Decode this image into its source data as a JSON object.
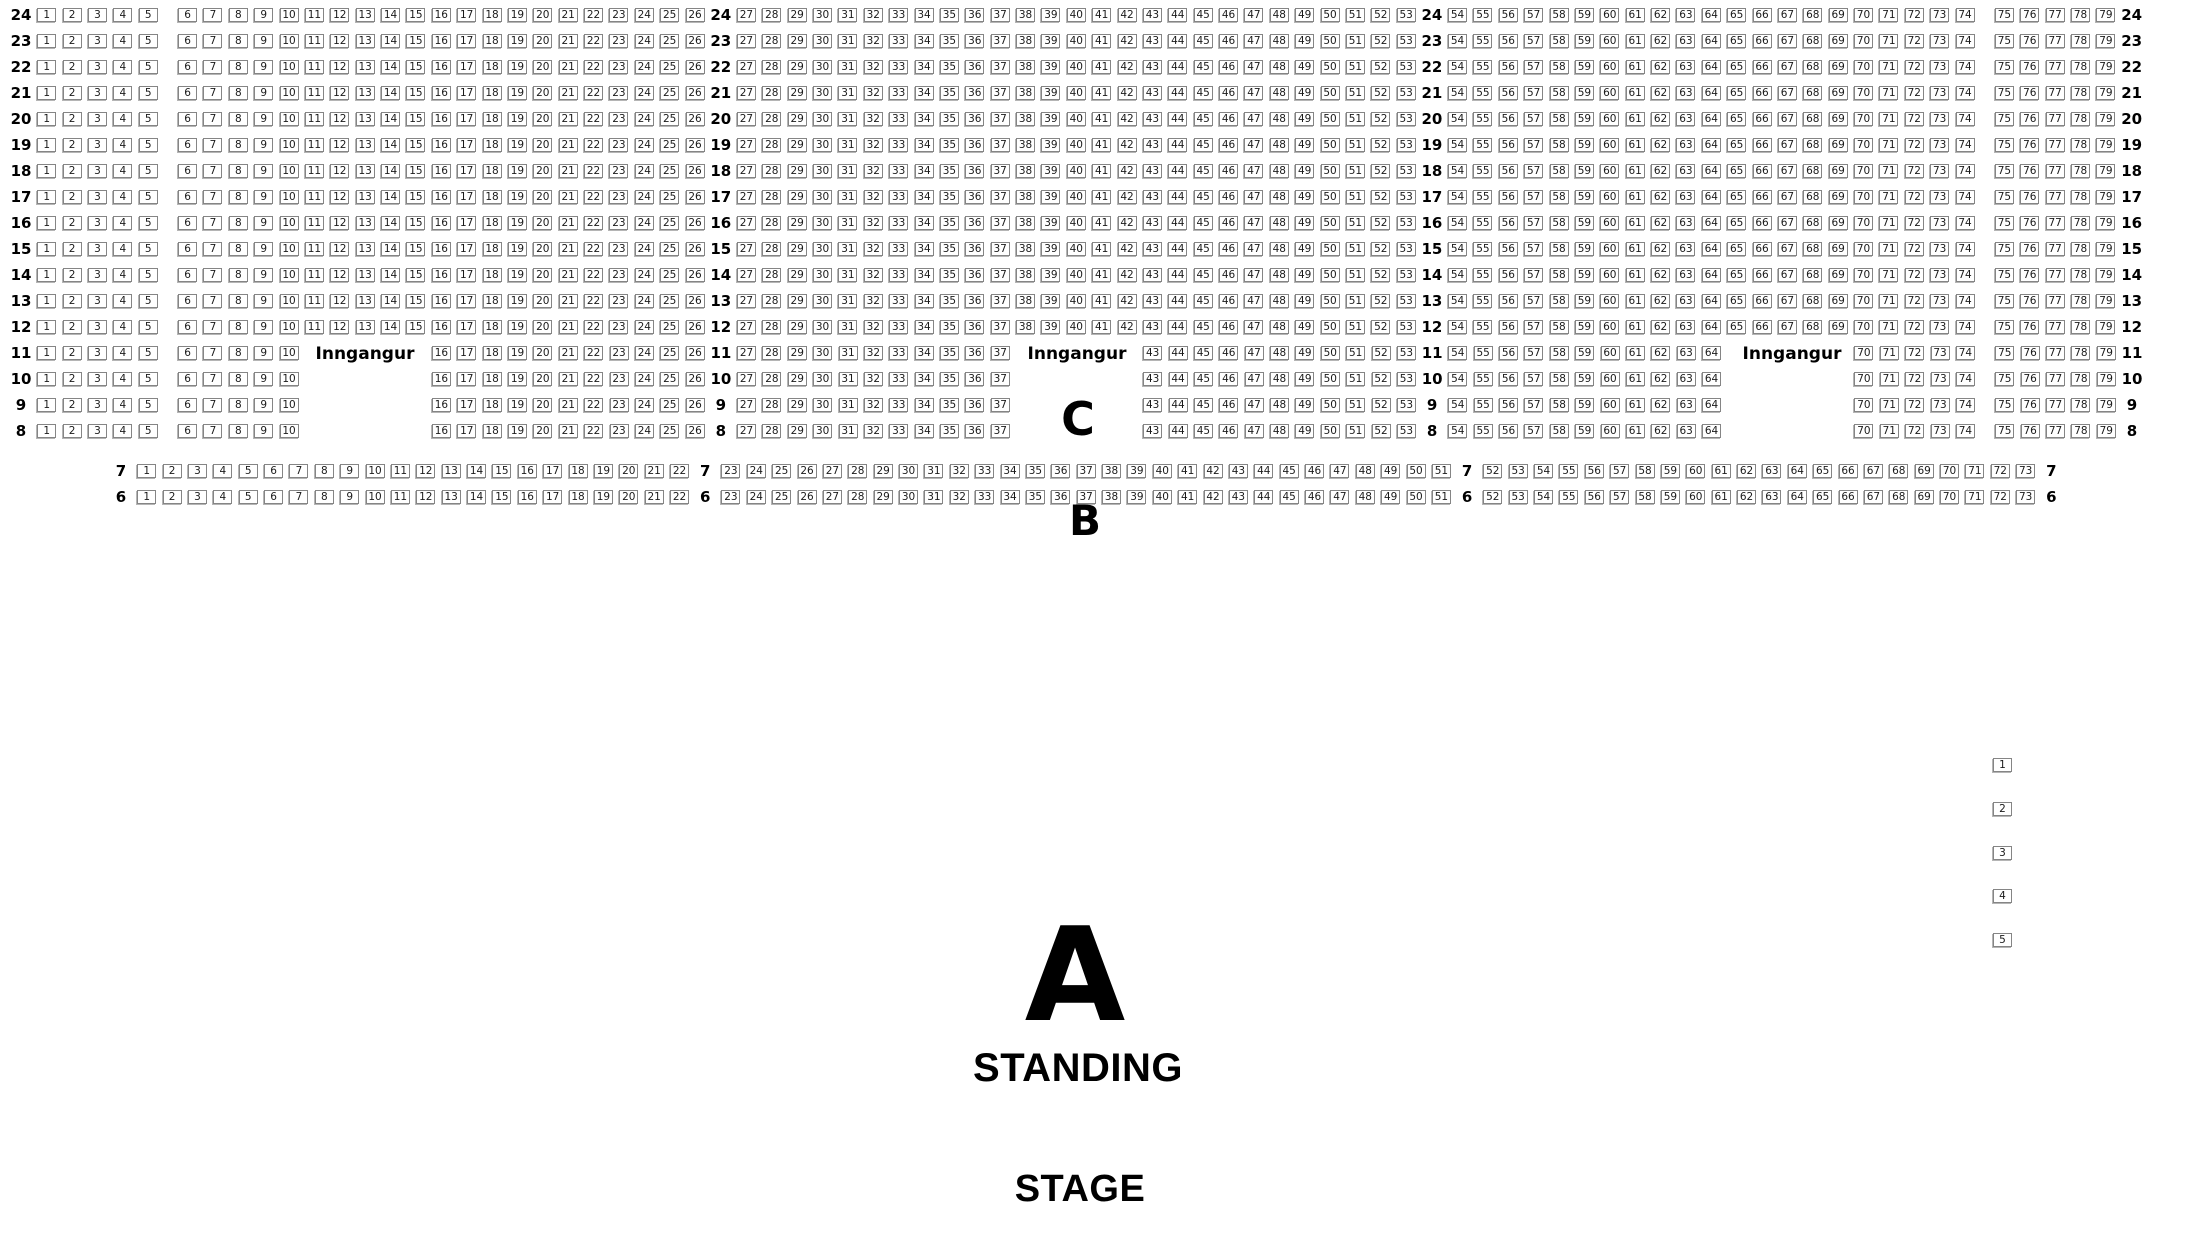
{
  "chart": {
    "labels": {
      "entrance": "Inngangur",
      "section_c": "C",
      "section_b": "B",
      "section_a": "A",
      "standing": "STANDING",
      "stage": "STAGE"
    },
    "row_groups": [
      {
        "name": "section-c-full-rows",
        "rows": [
          24,
          23,
          22,
          21,
          20,
          19,
          18,
          17,
          16,
          15,
          14,
          13,
          12
        ],
        "indent": 0,
        "segments": [
          {
            "t": "label"
          },
          {
            "t": "seats",
            "a": 1,
            "b": 5
          },
          {
            "t": "space",
            "w": 14
          },
          {
            "t": "seats",
            "a": 6,
            "b": 26
          },
          {
            "t": "label"
          },
          {
            "t": "seats",
            "a": 27,
            "b": 53
          },
          {
            "t": "label"
          },
          {
            "t": "seats",
            "a": 54,
            "b": 74
          },
          {
            "t": "space",
            "w": 14
          },
          {
            "t": "seats",
            "a": 75,
            "b": 79
          },
          {
            "t": "label"
          }
        ]
      },
      {
        "name": "section-c-entrance-rows",
        "rows": [
          11,
          10,
          9,
          8
        ],
        "indent": 0,
        "segments": [
          {
            "t": "label"
          },
          {
            "t": "seats",
            "a": 1,
            "b": 5
          },
          {
            "t": "space",
            "w": 14
          },
          {
            "t": "seats",
            "a": 6,
            "b": 10
          },
          {
            "t": "space",
            "w": 127
          },
          {
            "t": "seats",
            "a": 16,
            "b": 26
          },
          {
            "t": "label"
          },
          {
            "t": "seats",
            "a": 27,
            "b": 37
          },
          {
            "t": "space",
            "w": 127
          },
          {
            "t": "seats",
            "a": 43,
            "b": 53
          },
          {
            "t": "label"
          },
          {
            "t": "seats",
            "a": 54,
            "b": 64
          },
          {
            "t": "space",
            "w": 127
          },
          {
            "t": "seats",
            "a": 70,
            "b": 74
          },
          {
            "t": "space",
            "w": 14
          },
          {
            "t": "seats",
            "a": 75,
            "b": 79
          },
          {
            "t": "label"
          }
        ]
      },
      {
        "name": "section-b-rows",
        "rows": [
          7,
          6
        ],
        "indent": 100,
        "segments": [
          {
            "t": "label"
          },
          {
            "t": "seats",
            "a": 1,
            "b": 22
          },
          {
            "t": "label"
          },
          {
            "t": "seats",
            "a": 23,
            "b": 51
          },
          {
            "t": "label"
          },
          {
            "t": "seats",
            "a": 52,
            "b": 73
          },
          {
            "t": "label"
          }
        ]
      }
    ],
    "entrances": [
      "left",
      "center",
      "right"
    ],
    "side_seats": [
      1,
      2,
      3,
      4,
      5
    ]
  }
}
